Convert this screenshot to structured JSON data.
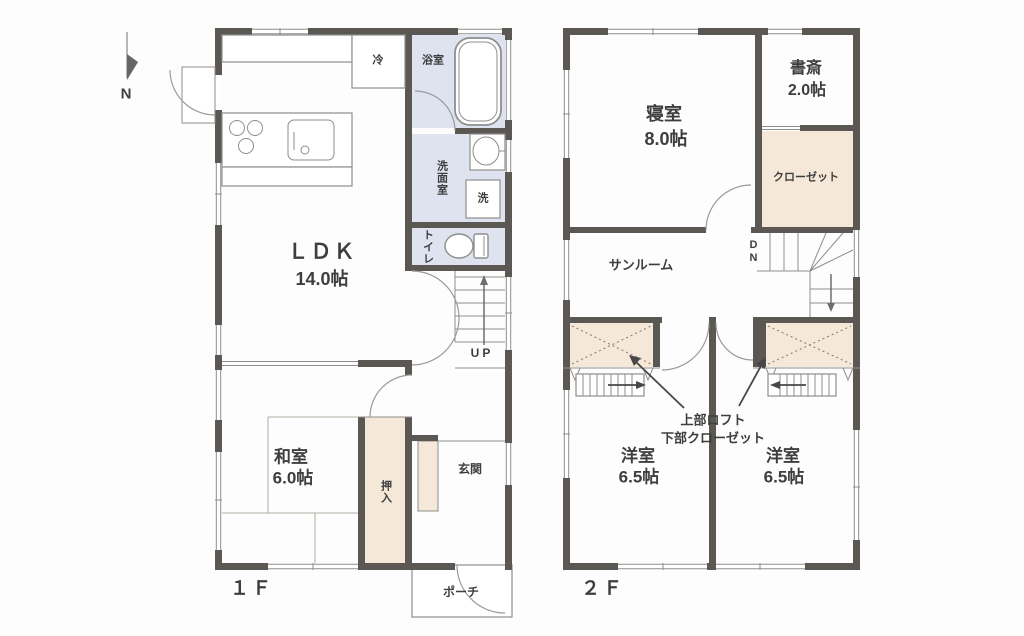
{
  "compass_label": "N",
  "floor1": {
    "floor_label": "１Ｆ",
    "ldk": {
      "name": "ＬＤＫ",
      "size": "14.0帖"
    },
    "washitsu": {
      "name": "和室",
      "size": "6.0帖"
    },
    "oshiire_label": "押入",
    "genkan_label": "玄関",
    "porch_label": "ポーチ",
    "bath_label": "浴室",
    "senmen_label": "洗面室",
    "toilet_label": "トイレ",
    "fridge_label": "冷",
    "washer_label": "洗",
    "stairs_label": "UP"
  },
  "floor2": {
    "floor_label": "２Ｆ",
    "bedroom": {
      "name": "寝室",
      "size": "8.0帖"
    },
    "study": {
      "name": "書斎",
      "size": "2.0帖"
    },
    "closet_label": "クローゼット",
    "sunroom_label": "サンルーム",
    "stairs_label": "DN",
    "western_left": {
      "name": "洋室",
      "size": "6.5帖"
    },
    "western_right": {
      "name": "洋室",
      "size": "6.5帖"
    },
    "loft_note_line1": "上部ロフト",
    "loft_note_line2": "下部クローゼット"
  },
  "colors": {
    "wall": "#5b5752",
    "wet_area": "#dfe3f0",
    "storage": "#f6e8d8",
    "line": "#8e8e8e",
    "text": "#3e3e3e"
  }
}
